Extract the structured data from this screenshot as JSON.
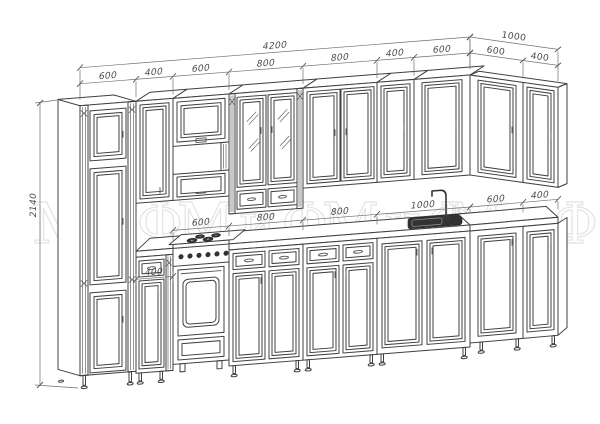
{
  "branding": {
    "watermark": "МиФ"
  },
  "dims": {
    "total_width": "4200",
    "height": "2140",
    "return_width": "1000",
    "top_chain": [
      "600",
      "400",
      "600",
      "800",
      "800",
      "400",
      "600"
    ],
    "top_return": [
      "600",
      "400"
    ],
    "counter_chain": [
      "600",
      "800",
      "800",
      "1000"
    ],
    "counter_return": [
      "600",
      "400"
    ],
    "small_left": "400"
  },
  "colors": {
    "line": "#404040",
    "dimension_line": "#707070",
    "label_text": "#4a4a4a",
    "watermark_stroke": "#e3e3e3",
    "background": "#ffffff",
    "sink_fill": "#2f2f2f"
  }
}
